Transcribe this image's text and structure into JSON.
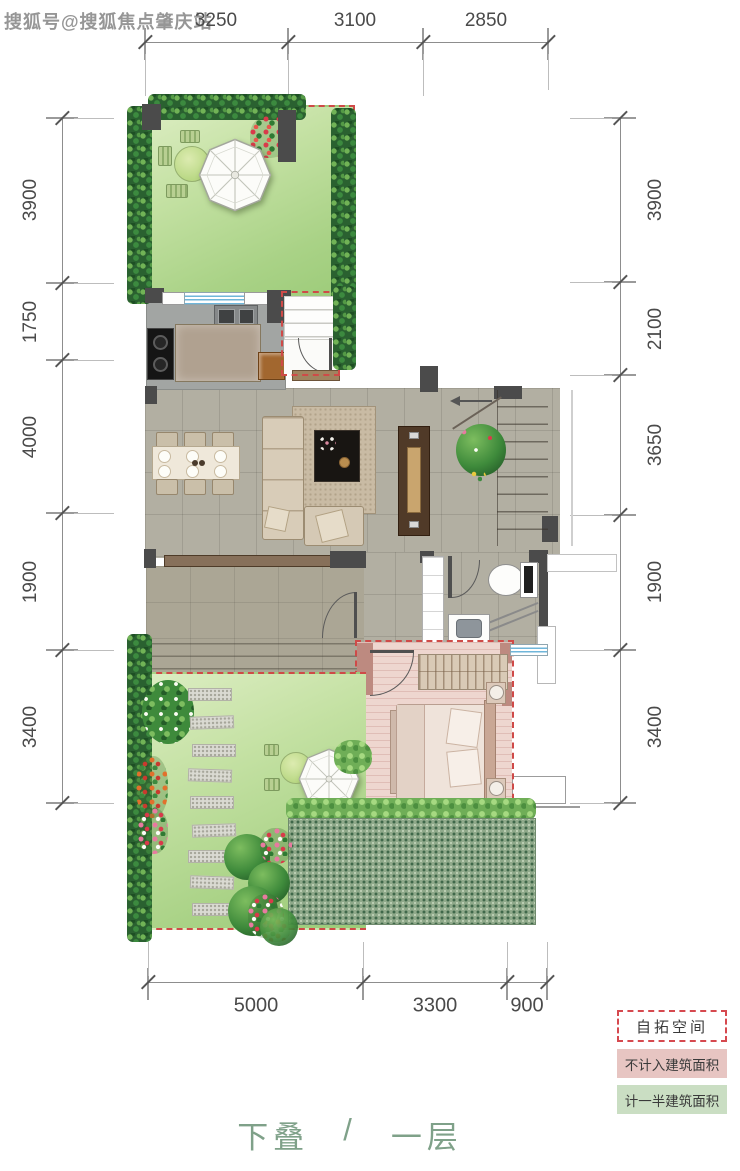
{
  "watermark": "搜狐号@搜狐焦点肇庆站",
  "dimensions": {
    "top": [
      "3250",
      "3100",
      "2850"
    ],
    "left": [
      "3900",
      "1750",
      "4000",
      "1900",
      "3400"
    ],
    "right": [
      "3900",
      "2100",
      "3650",
      "1900",
      "3400"
    ],
    "bottom": [
      "5000",
      "3300",
      "900"
    ]
  },
  "legend": {
    "items": [
      {
        "label": "自拓空间",
        "style": "dashed-outline"
      },
      {
        "label": "不计入建筑面积",
        "style": "pink-fill"
      },
      {
        "label": "计一半建筑面积",
        "style": "green-fill"
      }
    ]
  },
  "title": {
    "part1": "下叠",
    "separator": "/",
    "part2": "一层"
  },
  "colors": {
    "dash_red": "#cf4a48",
    "legend_pink": "#e7c5c2",
    "legend_green": "#cadec3",
    "title_green": "#7fa189",
    "lawn_green": "#b7db96",
    "hatch_green": "#8fa98a",
    "wall_gray": "#4b4b4b",
    "window_blue": "#6fb6da"
  }
}
